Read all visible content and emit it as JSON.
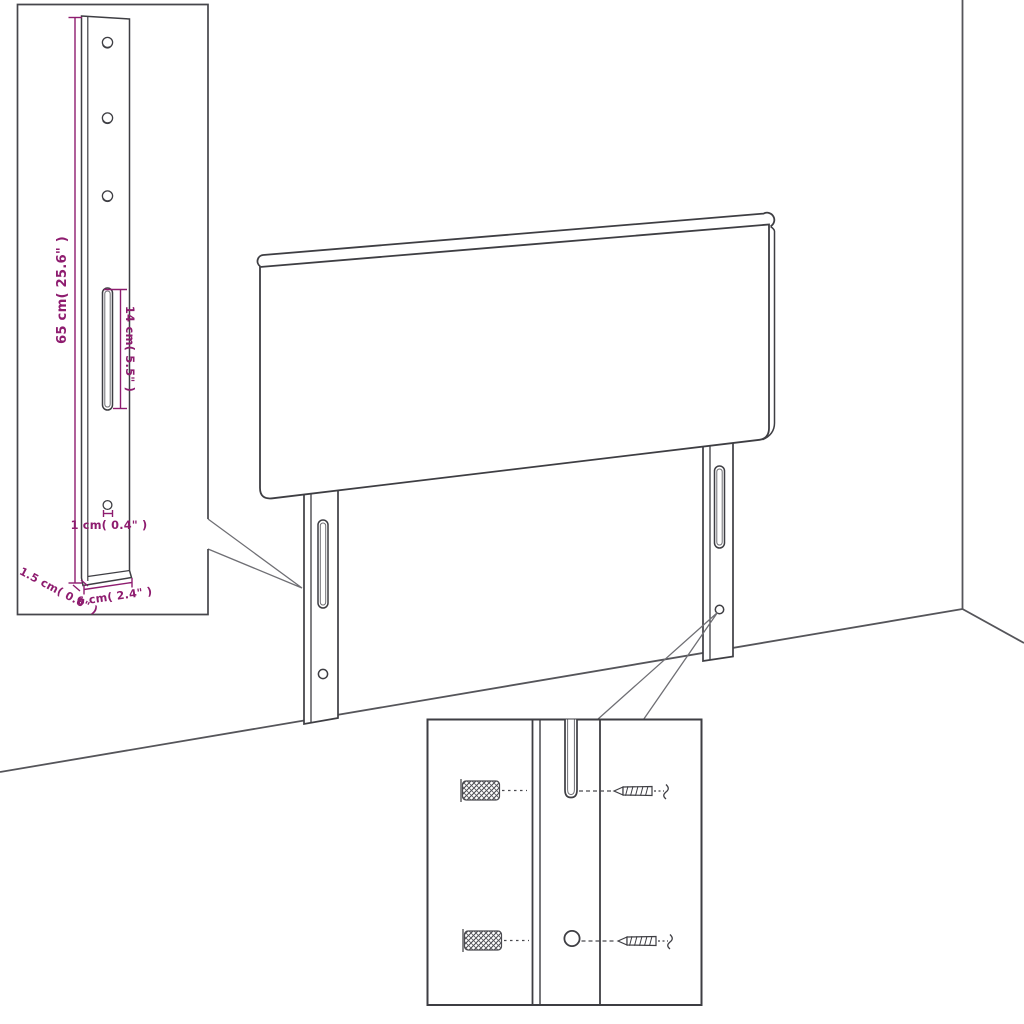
{
  "colors": {
    "line": "#3e3e43",
    "line_soft": "#6f6f74",
    "dimension": "#8e1c6f",
    "background": "#ffffff"
  },
  "dimensions": {
    "leg_height": "65 cm( 25.6\" )",
    "slot_length": "14 cm( 5.5\" )",
    "hole_size": "1 cm( 0.4\" )",
    "leg_thickness": "1.5 cm( 0.6\" )",
    "leg_width": "6 cm( 2.4\" )"
  }
}
